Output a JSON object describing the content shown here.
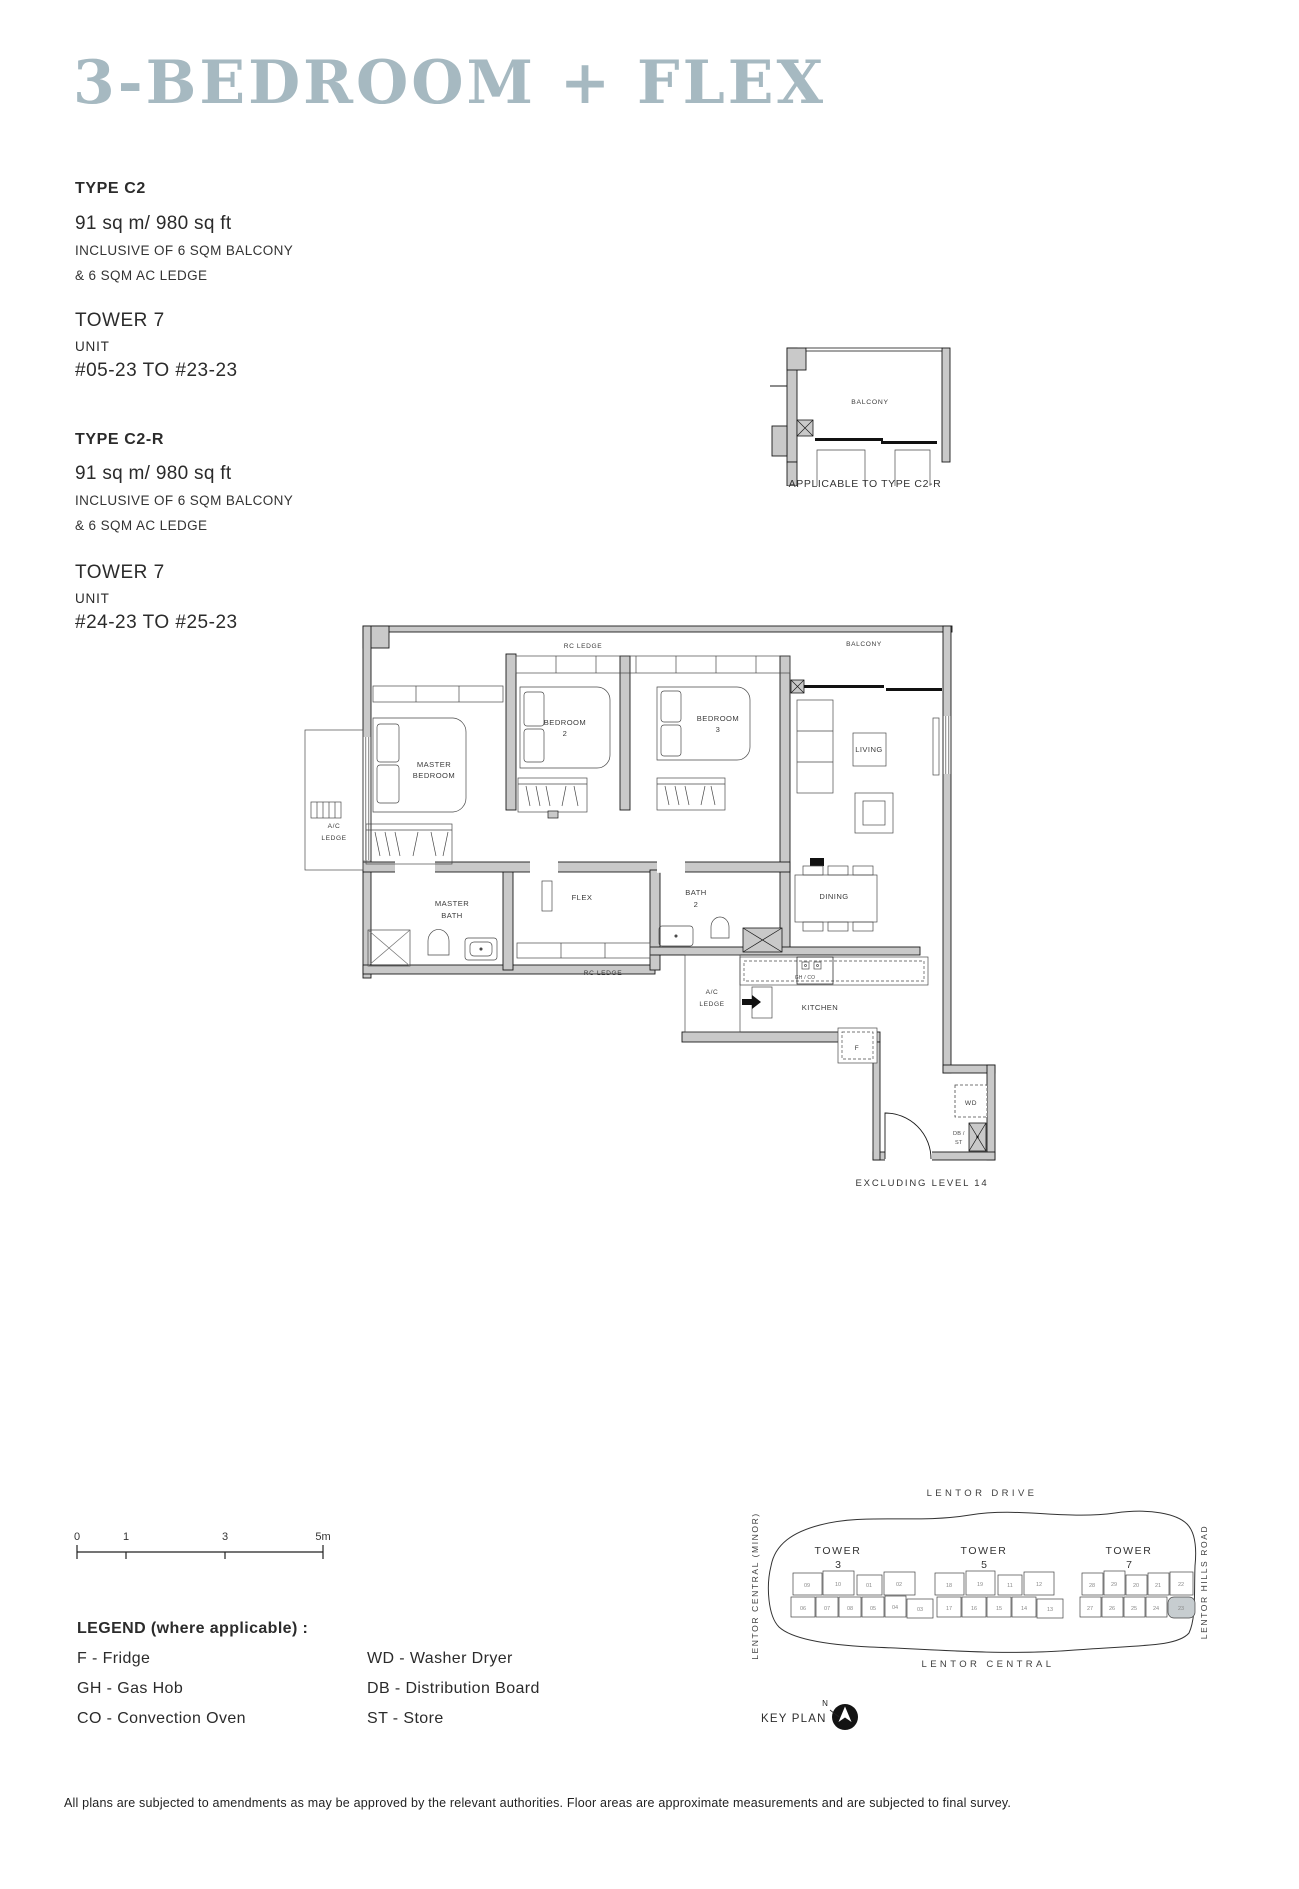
{
  "page": {
    "title": "3-BEDROOM + FLEX",
    "footer": "All plans are subjected to amendments as may be approved by the relevant authorities. Floor areas are approximate measurements and are subjected to final survey."
  },
  "specs": {
    "c2": {
      "type": "TYPE C2",
      "area": "91 sq m/ 980 sq ft",
      "inclusive_1": "INCLUSIVE OF 6 SQM BALCONY",
      "inclusive_2": "& 6 SQM AC LEDGE",
      "tower": "TOWER 7",
      "unit_label": "UNIT",
      "unit_range": "#05-23 TO #23-23"
    },
    "c2r": {
      "type": "TYPE C2-R",
      "area": "91 sq m/ 980 sq ft",
      "inclusive_1": "INCLUSIVE OF 6 SQM BALCONY",
      "inclusive_2": "& 6 SQM AC LEDGE",
      "tower": "TOWER 7",
      "unit_label": "UNIT",
      "unit_range": "#24-23 TO #25-23"
    }
  },
  "variant_plan": {
    "balcony": "BALCONY",
    "caption": "APPLICABLE TO TYPE C2-R"
  },
  "floor_plan": {
    "rc_ledge_top": "RC LEDGE",
    "balcony": "BALCONY",
    "master_bedroom_1": "MASTER",
    "master_bedroom_2": "BEDROOM",
    "bedroom2_1": "BEDROOM",
    "bedroom2_2": "2",
    "bedroom3_1": "BEDROOM",
    "bedroom3_2": "3",
    "living": "LIVING",
    "ac_ledge_left_1": "A/C",
    "ac_ledge_left_2": "LEDGE",
    "master_bath_1": "MASTER",
    "master_bath_2": "BATH",
    "flex": "FLEX",
    "bath2_1": "BATH",
    "bath2_2": "2",
    "dining": "DINING",
    "rc_ledge_bottom": "RC LEDGE",
    "ac_ledge_right_1": "A/C",
    "ac_ledge_right_2": "LEDGE",
    "kitchen": "KITCHEN",
    "hob": "GH / CO",
    "fridge": "F",
    "washer_dryer": "WD",
    "db": "DB /",
    "st": "ST",
    "note": "EXCLUDING LEVEL 14"
  },
  "scale_bar": {
    "t0": "0",
    "t1": "1",
    "t3": "3",
    "t5": "5m"
  },
  "legend": {
    "title": "LEGEND (where applicable) :",
    "col1": [
      "F - Fridge",
      "GH - Gas Hob",
      "CO - Convection Oven"
    ],
    "col2": [
      "WD - Washer Dryer",
      "DB - Distribution Board",
      "ST - Store"
    ]
  },
  "key_plan": {
    "label": "KEY PLAN",
    "north": "N",
    "road_top": "LENTOR DRIVE",
    "road_left": "LENTOR CENTRAL (MINOR)",
    "road_right": "LENTOR HILLS ROAD",
    "road_bottom": "LENTOR CENTRAL",
    "towers": [
      {
        "name": "TOWER",
        "num": "3",
        "top_row": [
          "09",
          "10",
          "01",
          "02"
        ],
        "bottom_row": [
          "06",
          "07",
          "08",
          "05",
          "04",
          "03"
        ]
      },
      {
        "name": "TOWER",
        "num": "5",
        "top_row": [
          "18",
          "19",
          "11",
          "12"
        ],
        "bottom_row": [
          "17",
          "16",
          "15",
          "14",
          "13"
        ]
      },
      {
        "name": "TOWER",
        "num": "7",
        "top_row": [
          "28",
          "29",
          "20",
          "21",
          "22"
        ],
        "bottom_row": [
          "27",
          "26",
          "25",
          "24",
          "23"
        ]
      }
    ]
  }
}
